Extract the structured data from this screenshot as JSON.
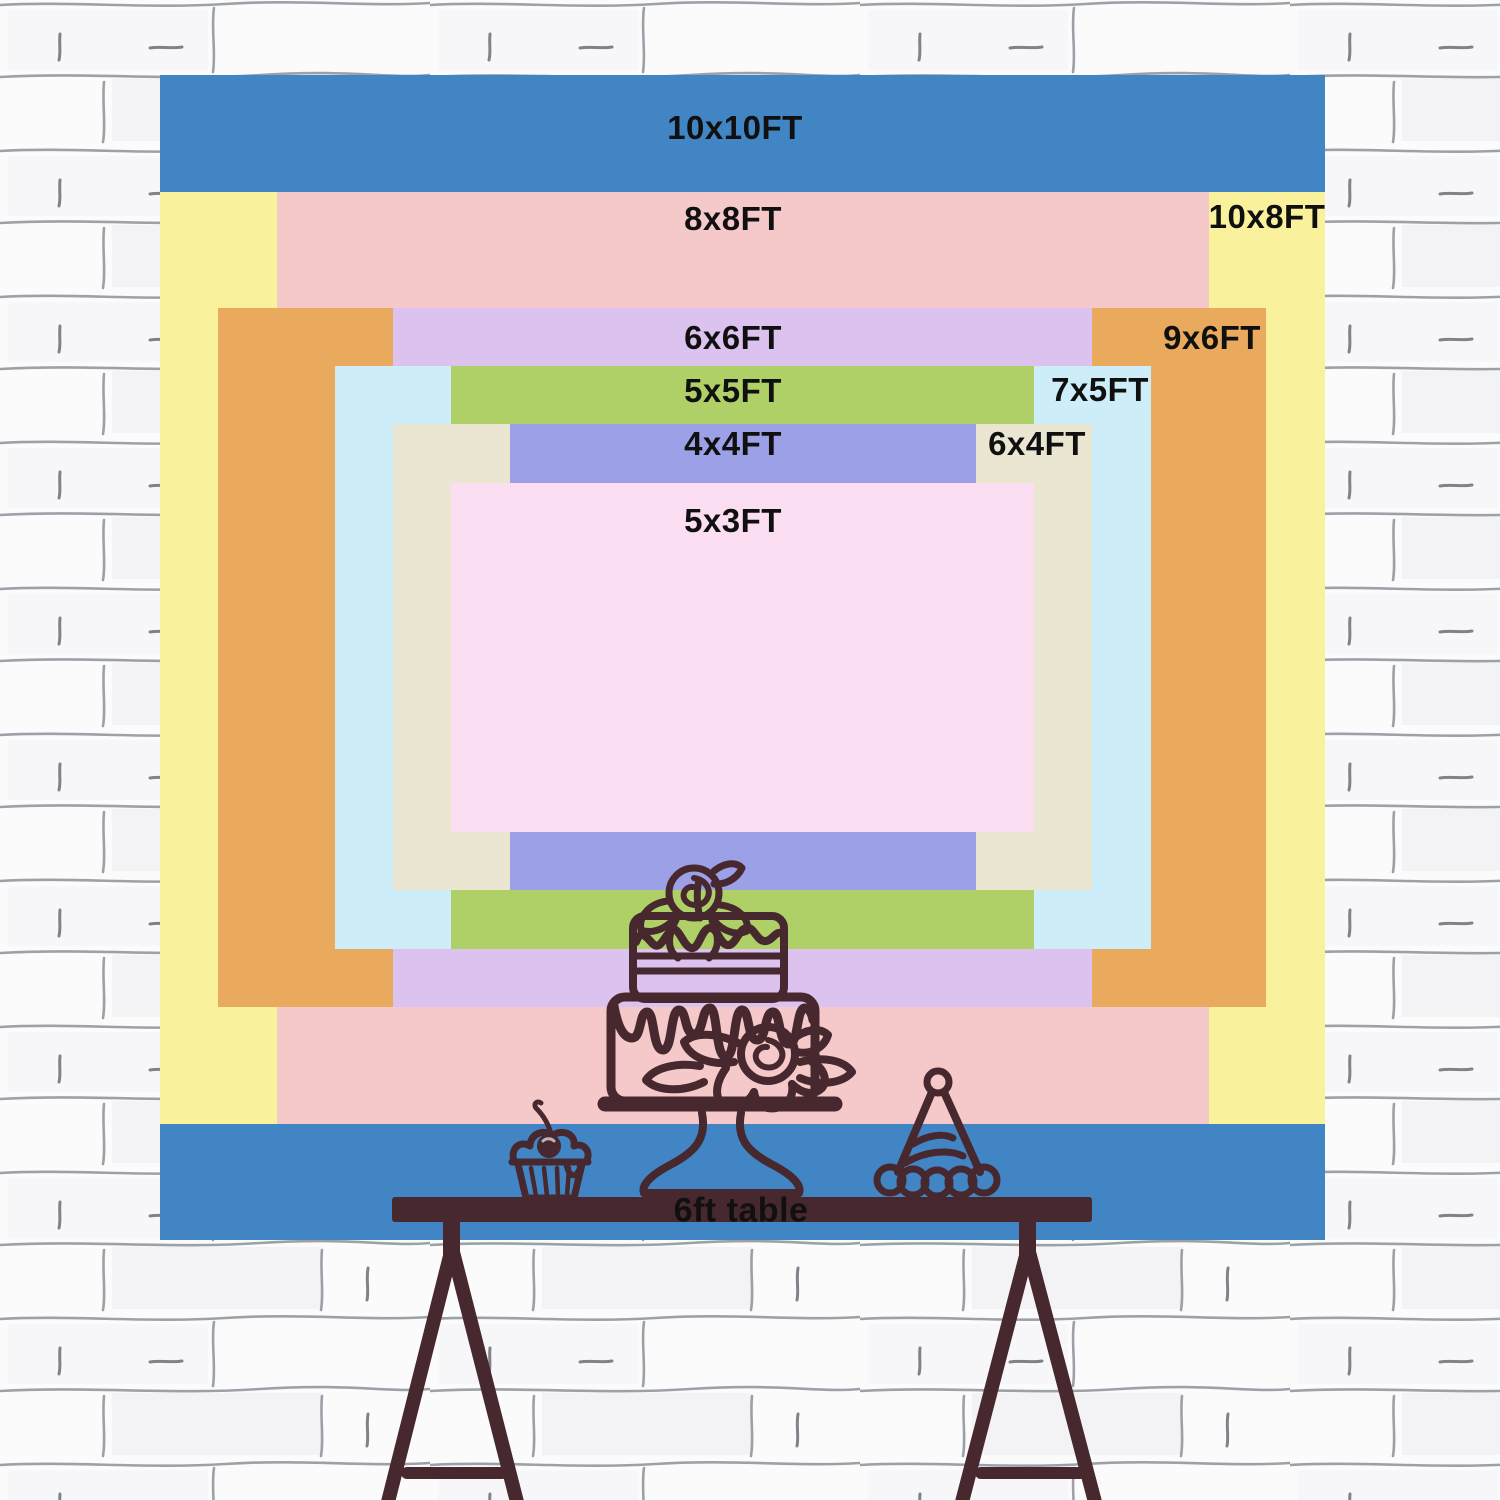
{
  "title": "Backdrop size comparison chart",
  "labels": {
    "size_10x10": "10x10FT",
    "size_8x8": "8x8FT",
    "size_10x8": "10x8FT",
    "size_6x6": "6x6FT",
    "size_9x6": "9x6FT",
    "size_5x5": "5x5FT",
    "size_7x5": "7x5FT",
    "size_4x4": "4x4FT",
    "size_6x4": "6x4FT",
    "size_5x3": "5x3FT",
    "table": "6ft table"
  },
  "sizes": [
    {
      "label": "10x10FT",
      "color_key": "size_10x10"
    },
    {
      "label": "10x8FT",
      "color_key": "size_10x8"
    },
    {
      "label": "8x8FT",
      "color_key": "size_8x8"
    },
    {
      "label": "9x6FT",
      "color_key": "size_9x6"
    },
    {
      "label": "6x6FT",
      "color_key": "size_6x6"
    },
    {
      "label": "7x5FT",
      "color_key": "size_7x5"
    },
    {
      "label": "5x5FT",
      "color_key": "size_5x5"
    },
    {
      "label": "6x4FT",
      "color_key": "size_6x4"
    },
    {
      "label": "4x4FT",
      "color_key": "size_4x4"
    },
    {
      "label": "5x3FT",
      "color_key": "size_5x3"
    }
  ],
  "colors": {
    "size_10x10": "#4285c4",
    "size_10x8": "#faf19d",
    "size_8x8": "#f5c9ca",
    "size_9x6": "#e9aa5e",
    "size_6x6": "#dcc2ef",
    "size_7x5": "#cdedf8",
    "size_5x5": "#aed066",
    "size_6x4": "#eae6d2",
    "size_4x4": "#9ba0e7",
    "size_5x3": "#fbdef1",
    "ink": "#46282e",
    "text": "#101010",
    "wall_bg": "#fbfbfc",
    "wall_line": "#7d838c"
  }
}
